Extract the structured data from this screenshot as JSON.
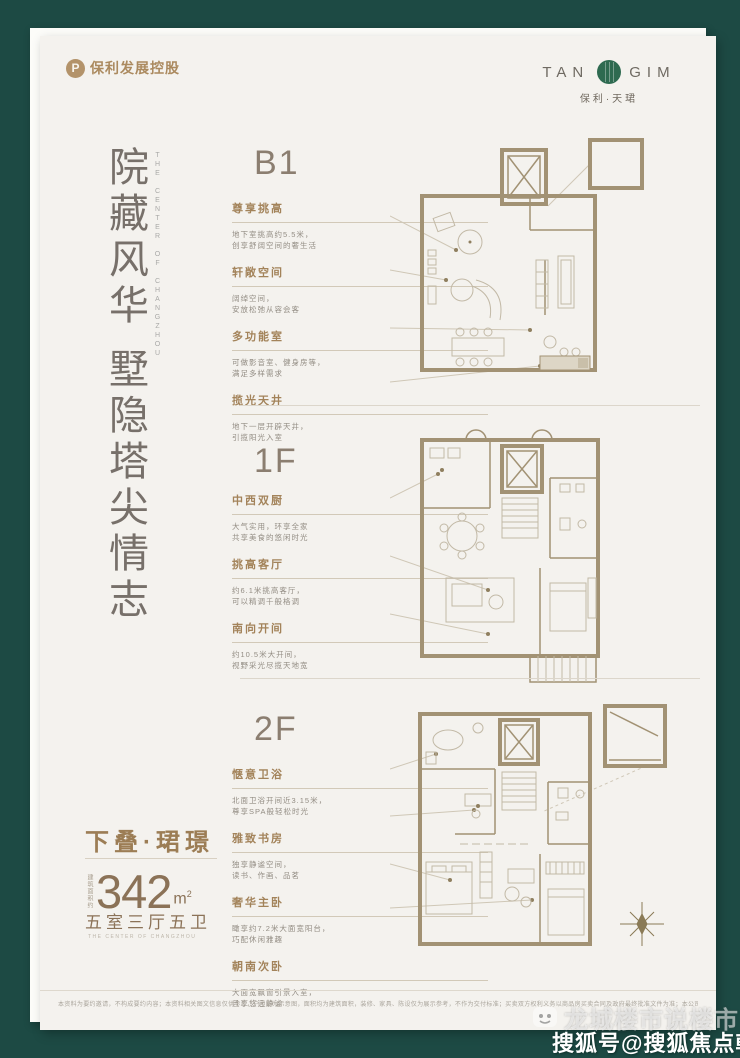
{
  "header": {
    "developer_mark": "P",
    "developer_name": "保利发展控股",
    "brand_en_left": "TAN",
    "brand_en_right": "GIM",
    "brand_cn": "保利·天珺"
  },
  "headline": {
    "part1": "院藏风华",
    "part2": "墅隐塔尖情志",
    "english": "THE CENTER OF CHANGZHOU"
  },
  "sections": [
    {
      "floor": "B1",
      "features": [
        {
          "title": "尊享挑高",
          "line1": "地下室挑高约5.5米，",
          "line2": "创享舒阔空间的奢生活"
        },
        {
          "title": "轩敞空间",
          "line1": "阔绰空间，",
          "line2": "安放松弛从容会客"
        },
        {
          "title": "多功能室",
          "line1": "可做影音室、健身房等，",
          "line2": "满足多样需求"
        },
        {
          "title": "揽光天井",
          "line1": "地下一层开辟天井，",
          "line2": "引揽阳光入室"
        }
      ]
    },
    {
      "floor": "1F",
      "features": [
        {
          "title": "中西双厨",
          "line1": "大气实用，环享全家",
          "line2": "共享美食的悠闲时光"
        },
        {
          "title": "挑高客厅",
          "line1": "约6.1米挑高客厅，",
          "line2": "可以精调千般格调"
        },
        {
          "title": "南向开间",
          "line1": "约10.5米大开间，",
          "line2": "视野采光尽揽天地宽"
        }
      ]
    },
    {
      "floor": "2F",
      "features": [
        {
          "title": "惬意卫浴",
          "line1": "北面卫浴开间近3.15米，",
          "line2": "尊享SPA般轻松时光"
        },
        {
          "title": "雅致书房",
          "line1": "独享静谧空间，",
          "line2": "读书、作画、品茗"
        },
        {
          "title": "奢华主卧",
          "line1": "瞰享约7.2米大面宽阳台，",
          "line2": "巧配休闲雅趣"
        },
        {
          "title": "朝南次卧",
          "line1": "大面宽飘窗引景入室，",
          "line2": "且享悠远静谧"
        }
      ]
    }
  ],
  "unit": {
    "name": "下叠·珺璟",
    "area_label": "建筑面积约",
    "area_value": "342",
    "area_unit": "m",
    "area_sup": "2",
    "rooms": "五室三厅五卫",
    "slogan_en": "THE CENTER OF CHANGZHOU"
  },
  "footer": {
    "disclaimer": "本资料为要约邀请，不构成要约内容；本资料相关图文信息仅供参考，户型图为示意图，面积均为建筑面积，装修、家具、陈设仅为展示参考，不作为交付标准；买卖双方权利义务以商品房买卖合同及政府最终批准文件为准；本公司保留对宣传资料修改、解释的权利；广告制作时间2023年，敬请知悉。"
  },
  "watermarks": {
    "account": "龙城楼市说楼市",
    "platform": "搜狐号@搜狐焦点朝阳站"
  },
  "colors": {
    "background": "#1d4a44",
    "card": "#f4f2ee",
    "bronze": "#a3835a",
    "brand_green": "#2e6a50"
  }
}
